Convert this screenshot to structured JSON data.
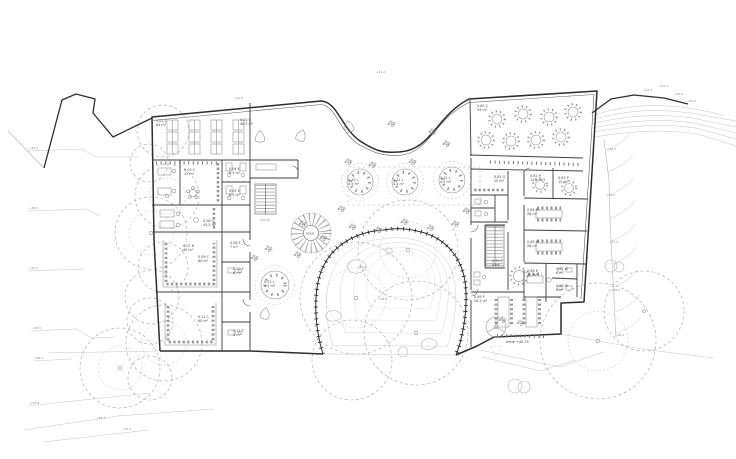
{
  "colors": {
    "wall": "#2e2e2e",
    "interior_wall": "#3d3d3d",
    "furniture": "#8a8a8a",
    "contour": "#c6c6c6",
    "tree": "#a5a5a5",
    "label": "#4a4a4a"
  },
  "rooms": [
    {
      "c": "0.01 C",
      "a": "63 m²"
    },
    {
      "c": "0.02 C",
      "a": "48.5 m²"
    },
    {
      "c": "0.03 C",
      "a": "15 m²"
    },
    {
      "c": "0.04 K",
      "a": "6.5 m²"
    },
    {
      "c": "0.05 K",
      "a": "6.5 m²"
    },
    {
      "c": "0.06 C",
      "a": "43.5 m²"
    },
    {
      "c": "0.07 B",
      "a": "40 m²"
    },
    {
      "c": "0.08 F",
      "a": "7 m²"
    },
    {
      "c": "0.09 C",
      "a": "60 m²"
    },
    {
      "c": "0.10 F",
      "a": "6 m²"
    },
    {
      "c": "0.11 C",
      "a": "60 m²"
    },
    {
      "c": "0.12 F",
      "a": "6 m²"
    },
    {
      "c": "0.20 L",
      "a": "4.5 m²"
    },
    {
      "c": "0.21 L",
      "a": "4.5 m²"
    },
    {
      "c": "0.22 L",
      "a": "4.5 m²"
    },
    {
      "c": "0.23 L",
      "a": "4.5 m²"
    },
    {
      "c": "0.60 C",
      "a": "93 m²"
    },
    {
      "c": "0.61 G",
      "a": "10 m²"
    },
    {
      "c": "0.62 P",
      "a": "12.5 m²"
    },
    {
      "c": "0.63 P",
      "a": "15 m²"
    },
    {
      "c": "0.64 M",
      "a": "28 m²"
    },
    {
      "c": "0.65 M",
      "a": "28 m²"
    },
    {
      "c": "0.66 K",
      "a": "20 m²"
    },
    {
      "c": "0.67 W",
      "a": "6 m²"
    },
    {
      "c": "0.68 W",
      "a": "6 m²"
    },
    {
      "c": "0.69 P",
      "a": "24.5 m²"
    },
    {
      "c": "0.70 T",
      "a": "8 m²"
    }
  ],
  "misc": {
    "fan_label": "scen",
    "entrance_label": "entré +40.35"
  },
  "site": {
    "elev": [
      "+39.0",
      "+38.0",
      "+37.0",
      "+36.5",
      "+36.2",
      "+35.8",
      "+35.4",
      "+35.2",
      "+41.0",
      "+41.2",
      "+40.45",
      "+39.5",
      "+38.5",
      "+37.5",
      "+36.5",
      "+36.0",
      "+41.3",
      "+41.1",
      "+40.9",
      "+40.6",
      "+38.6",
      "+38.2"
    ]
  }
}
